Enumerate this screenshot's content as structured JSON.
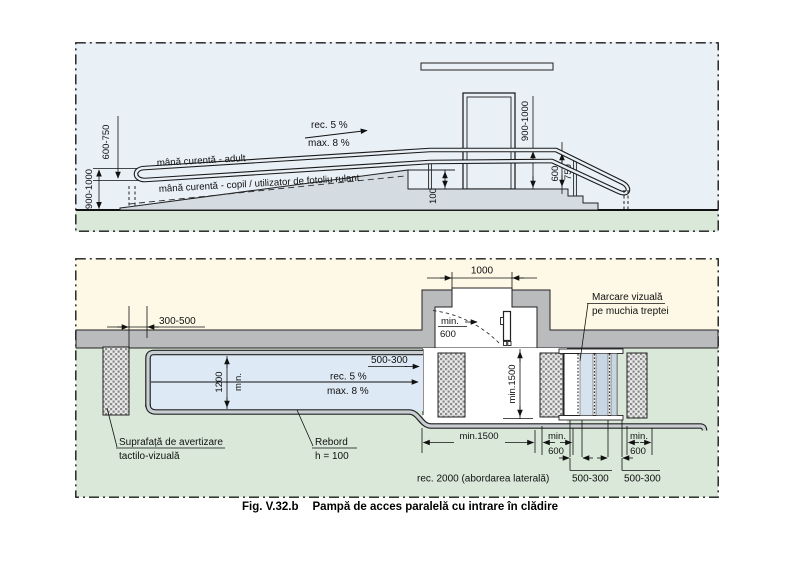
{
  "caption": {
    "fig": "Fig. V.32.b",
    "title": "Pampă de acces paralelă cu intrare în clădire"
  },
  "colors": {
    "elevation_bg": "#e9f0f6",
    "ground_green": "#d9e8d8",
    "interior_beige": "#fdf9e6",
    "wall_gray": "#b9bbbd",
    "ramp_blue": "#dde9f4",
    "concrete_gray": "#d4dce2",
    "rebord_gray": "#c9ced2"
  },
  "elevation": {
    "labels": {
      "handrail_adult": "mână curentă - adult",
      "handrail_child": "mână curentă - copil / utilizator de fotoliu rulant",
      "slope_rec": "rec. 5 %",
      "slope_max": "max. 8 %",
      "left_rail_height": "600-750",
      "left_total_height": "900-1000",
      "door_rail_height": "900-1000",
      "stair_rail_height_1": "600-",
      "stair_rail_height_2": "750",
      "curb_height": "100"
    }
  },
  "plan": {
    "labels": {
      "door_width": "1000",
      "door_clear_min": "min.",
      "door_clear_val": "600",
      "edge_offset": "300-500",
      "ramp_width_val": "1200",
      "ramp_width_min": "min.",
      "top_strip": "500-300",
      "slope_rec": "rec. 5 %",
      "slope_max": "max. 8 %",
      "landing_width": "min.1500",
      "landing_depth": "min.1500",
      "side_clear1_min": "min.",
      "side_clear1_val": "600",
      "side_clear2_min": "min.",
      "side_clear2_val": "600",
      "step_mark1": "500-300",
      "step_mark2": "500-300",
      "approach": "rec. 2000 (abordarea laterală)",
      "marking_1": "Marcare vizuală",
      "marking_2": "pe muchia treptei",
      "warning_1": "Suprafață de avertizare",
      "warning_2": "tactilo-vizuală",
      "rebord_1": "Rebord",
      "rebord_2": "h = 100"
    }
  }
}
